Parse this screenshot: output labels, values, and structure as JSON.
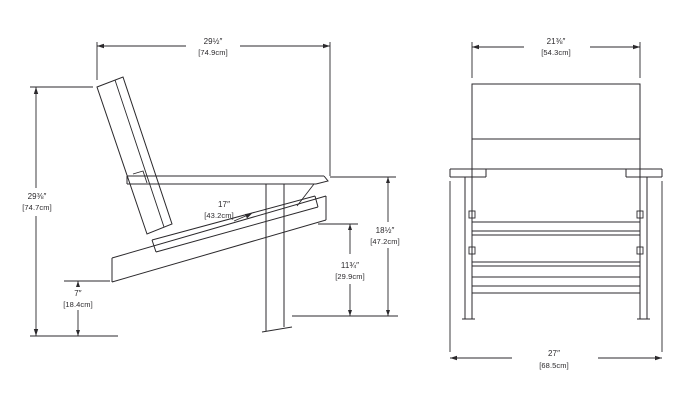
{
  "page": {
    "background": "#ffffff",
    "line_color": "#2b292c",
    "description": "Adirondack chair dimension drawing, side view and front view"
  },
  "side_view": {
    "depth": {
      "in": "29½″",
      "cm": "[74.9cm]"
    },
    "height": {
      "in": "29⅜″",
      "cm": "[74.7cm]"
    },
    "seat_depth": {
      "in": "17″",
      "cm": "[43.2cm]"
    },
    "clearance": {
      "in": "7″",
      "cm": "[18.4cm]"
    },
    "seat_height": {
      "in": "11¾″",
      "cm": "[29.9cm]"
    },
    "arm_height": {
      "in": "18½″",
      "cm": "[47.2cm]"
    }
  },
  "front_view": {
    "back_width": {
      "in": "21⅜″",
      "cm": "[54.3cm]"
    },
    "overall_width": {
      "in": "27″",
      "cm": "[68.5cm]"
    }
  }
}
